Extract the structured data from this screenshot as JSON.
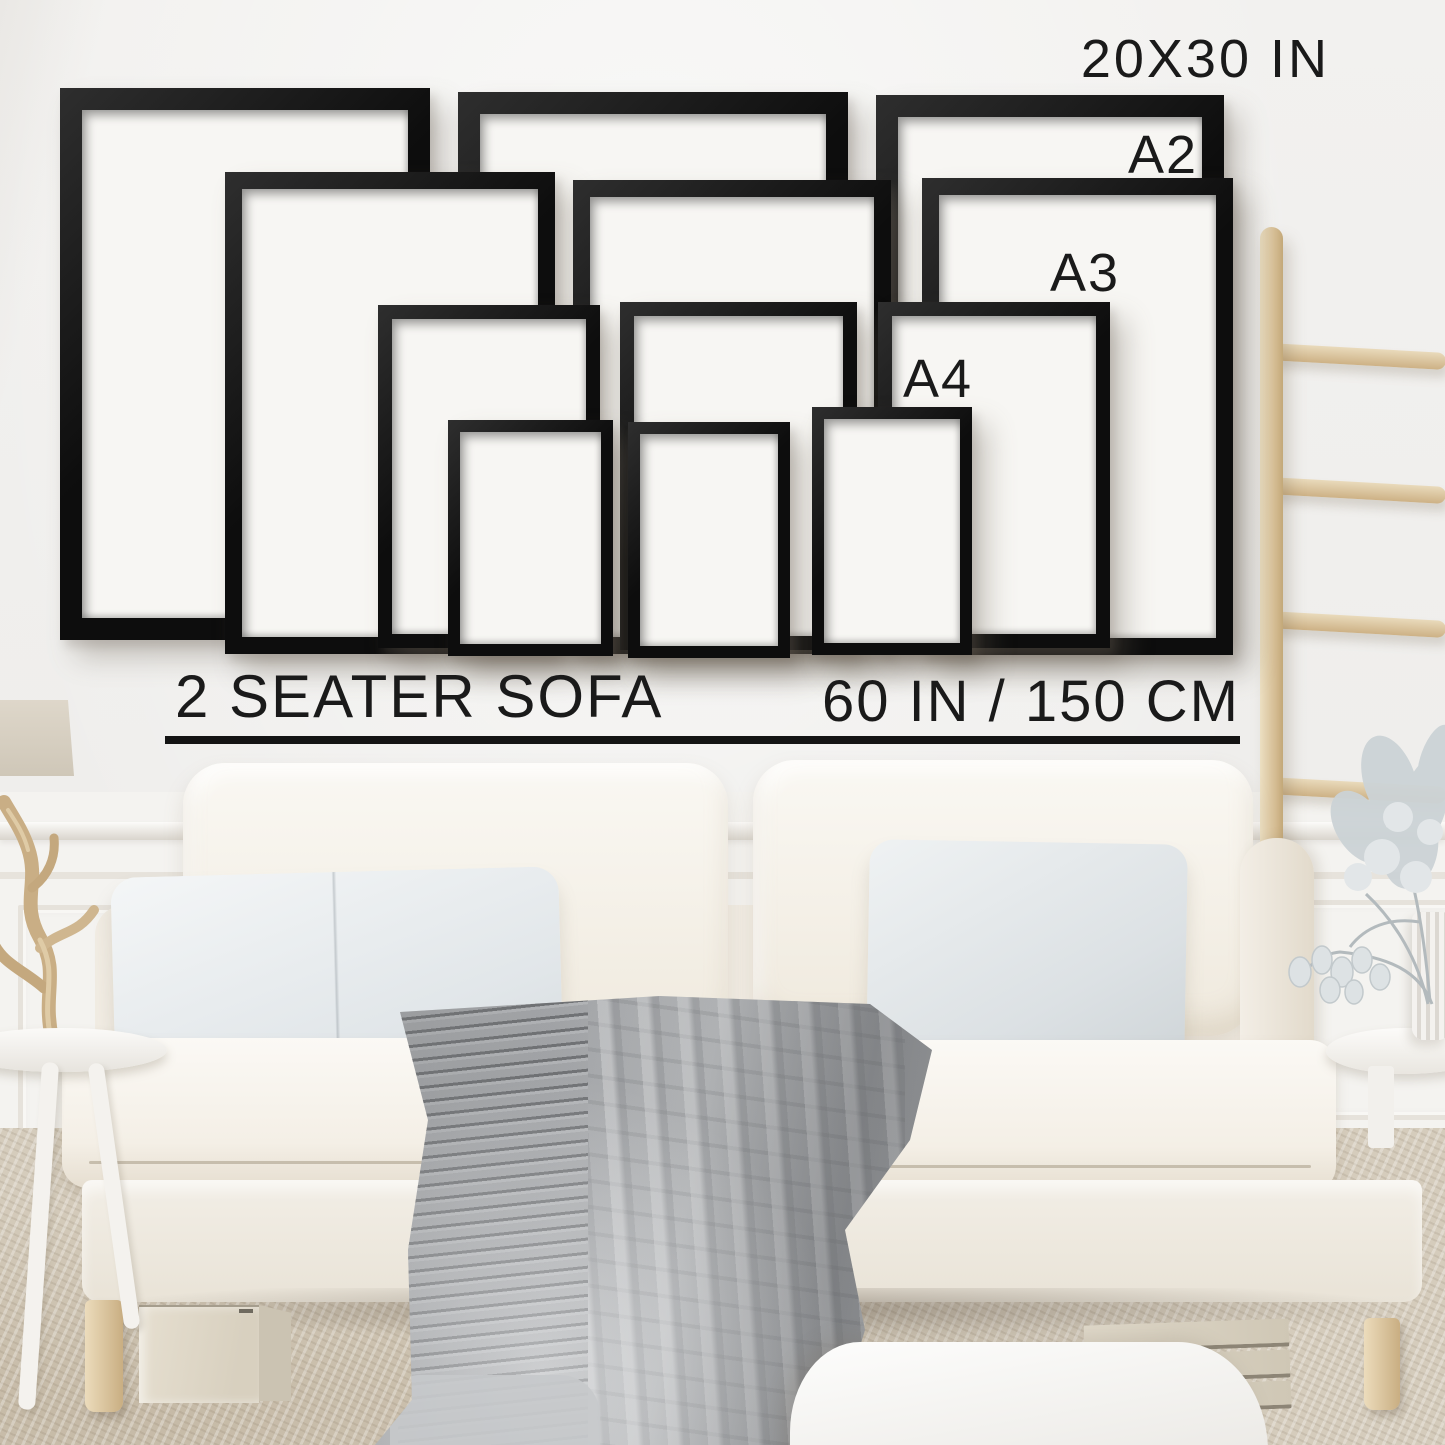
{
  "labels": {
    "largest_size": "20X30 IN",
    "a2": "A2",
    "a3": "A3",
    "a4": "A4",
    "sofa": "2 SEATER SOFA",
    "sofa_width": "60 IN / 150 CM"
  },
  "size_guide": {
    "frame_sizes": [
      "20X30 IN",
      "A2",
      "A3",
      "A4"
    ],
    "frames_per_size": 3,
    "reference_object": "2 SEATER SOFA",
    "reference_width": "60 IN / 150 CM"
  },
  "colors": {
    "frame_black": "#111111",
    "wall": "#f0efec",
    "label_text": "#1a1a1a",
    "carpet_beige": "#d5ccbc",
    "sofa_cream": "#f7f4ee",
    "pillow_gray": "#e7ebed",
    "blanket_gray": "#acaeb0",
    "wood_light": "#ddc9a6"
  }
}
